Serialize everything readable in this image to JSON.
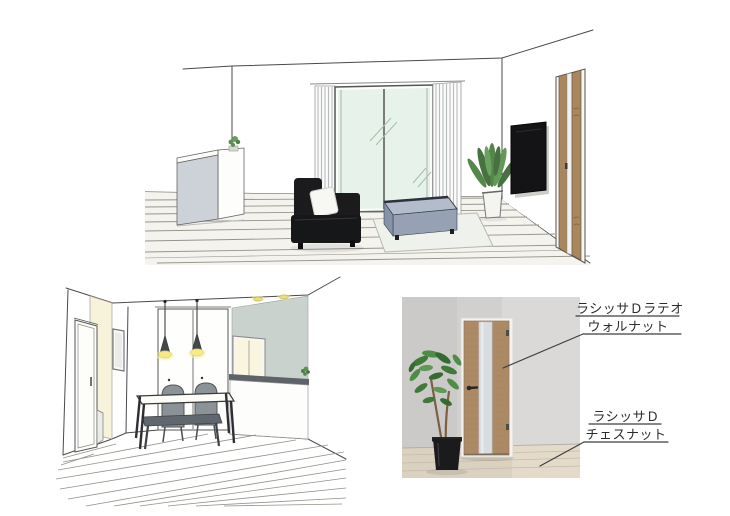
{
  "canvas": {
    "width": 730,
    "height": 516,
    "background": "#ffffff"
  },
  "labels": {
    "door": {
      "line1": "ラシッサＤラテオ",
      "line2": "ウォルナット"
    },
    "floor": {
      "line1": "ラシッサＤ",
      "line2": "チェスナット"
    }
  },
  "colors": {
    "walnut_door": "#ac8a66",
    "chestnut_floor": "#dbd1c1",
    "frosted_glass": "#d8dde2",
    "sketch_line": "#4a4a4a",
    "sofa_black": "#1b1b1d",
    "ottoman_blue_gray": "#96a1b4",
    "window_glass_mint": "#e7f2ea",
    "pendant_glow_yellow": "#f5ea85",
    "accent_wall_cream": "#f6f3da",
    "kitchen_wall_gray": "#cad2ce",
    "chair_gray": "#8b9298",
    "sketch_door_wood": "#a8865e"
  }
}
